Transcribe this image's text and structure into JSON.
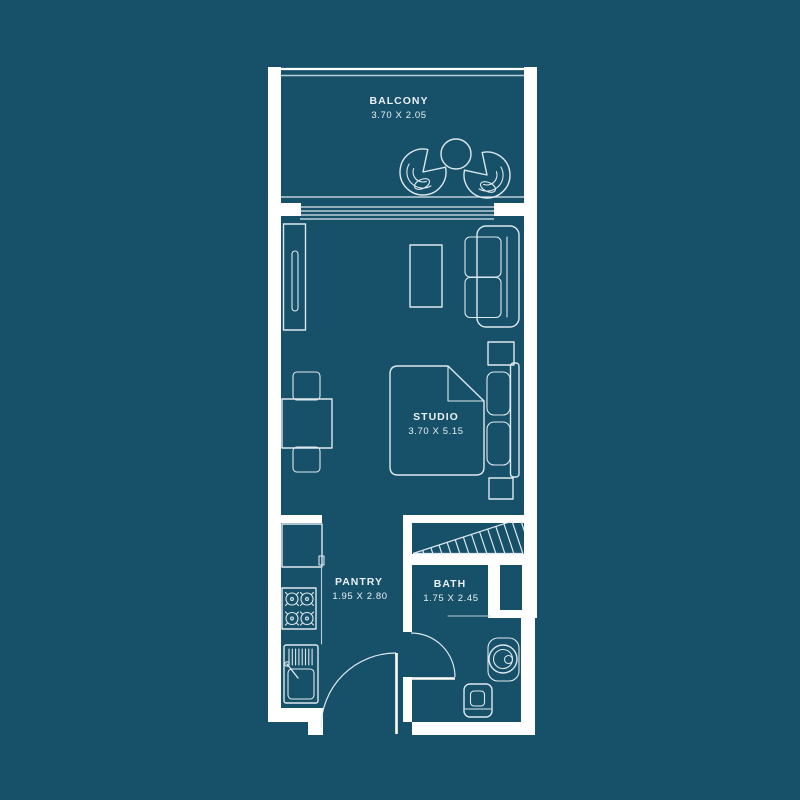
{
  "colors": {
    "background": "#175069",
    "wall": "#ffffff",
    "line": "#dde8ed",
    "line-dim": "#b8cdd6",
    "text": "#e8f0f3"
  },
  "rooms": {
    "balcony": {
      "label": "BALCONY",
      "dimensions": "3.70 X 2.05"
    },
    "studio": {
      "label": "STUDIO",
      "dimensions": "3.70 X 5.15"
    },
    "pantry": {
      "label": "PANTRY",
      "dimensions": "1.95 X 2.80"
    },
    "bath": {
      "label": "BATH",
      "dimensions": "1.75 X 2.45"
    }
  }
}
